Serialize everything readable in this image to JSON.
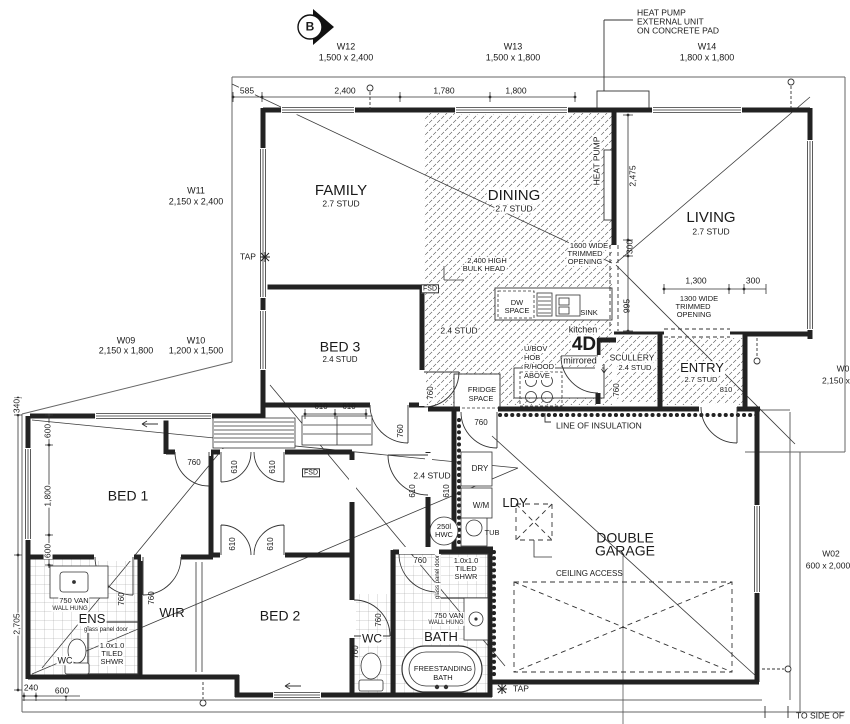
{
  "compass": {
    "label": "B"
  },
  "notes": {
    "heat_pump_unit": [
      "HEAT PUMP",
      "EXTERNAL UNIT",
      "ON CONCRETE PAD"
    ],
    "heat_pump_wall": "HEAT PUMP",
    "bulkhead": [
      "2,400 HIGH",
      "BULK HEAD"
    ],
    "trimmed_opening_1600": [
      "1600 WIDE",
      "TRIMMED",
      "OPENING"
    ],
    "trimmed_opening_1300": [
      "1300 WIDE",
      "TRIMMED",
      "OPENING"
    ],
    "line_of_insulation": "LINE OF INSULATION",
    "ceiling_access": "CEILING ACCESS",
    "to_side_of": "TO SIDE OF",
    "tap": "TAP",
    "fsd": "FSD",
    "glass_panel_door": "glass panel door",
    "kitchen": "kitchen",
    "kitchen_code": "4D",
    "mirrored": "mirrored"
  },
  "windows": {
    "w12": {
      "id": "W12",
      "size": "1,500 x 2,400"
    },
    "w13": {
      "id": "W13",
      "size": "1,500 x 1,800"
    },
    "w14": {
      "id": "W14",
      "size": "1,800 x 1,800"
    },
    "w11": {
      "id": "W11",
      "size": "2,150 x 2,400"
    },
    "w09": {
      "id": "W09",
      "size": "2,150 x 1,800"
    },
    "w10": {
      "id": "W10",
      "size": "1,200 x 1,500"
    },
    "w02": {
      "id": "W02",
      "size": "600 x 2,000"
    },
    "w01": {
      "id": "W0",
      "size": "2,150 x"
    }
  },
  "rooms": {
    "family": {
      "name": "FAMILY",
      "stud": "2.7 STUD"
    },
    "dining": {
      "name": "DINING",
      "stud": "2.7 STUD"
    },
    "living": {
      "name": "LIVING",
      "stud": "2.7 STUD"
    },
    "entry": {
      "name": "ENTRY",
      "stud": "2.7 STUD"
    },
    "scullery": {
      "name": "SCULLERY",
      "stud": "2.4 STUD"
    },
    "bed3": {
      "name": "BED 3",
      "stud": "2.4 STUD"
    },
    "bed1": {
      "name": "BED 1"
    },
    "bed2": {
      "name": "BED 2"
    },
    "wir": {
      "name": "WIR"
    },
    "ens": {
      "name": "ENS"
    },
    "wc": {
      "name": "WC"
    },
    "bath": {
      "name": "BATH"
    },
    "ldy": {
      "name": "LDY"
    },
    "garage": {
      "name1": "DOUBLE",
      "name2": "GARAGE"
    },
    "stud24": "2.4 STUD"
  },
  "fixtures": {
    "dw": [
      "DW",
      "SPACE"
    ],
    "sink": "SINK",
    "hob": [
      "U/BOV",
      "HOB",
      "R/HOOD",
      "ABOVE"
    ],
    "fridge": [
      "FRIDGE",
      "SPACE"
    ],
    "dry": "DRY",
    "wm": "W/M",
    "tub": "TUB",
    "hwc": [
      "250l",
      "HWC"
    ],
    "vanity": [
      "750 VAN",
      "WALL HUNG"
    ],
    "shower": [
      "1.0x1.0",
      "TILED",
      "SHWR"
    ],
    "bath_tub": [
      "FREESTANDING",
      "BATH"
    ]
  },
  "dims": {
    "d585": "585",
    "d2400": "2,400",
    "d1780": "1,780",
    "d1800": "1,800",
    "d2475": "2,475",
    "d300": "300",
    "d995": "995",
    "d1300": "1,300",
    "d610": "610",
    "d760": "760",
    "d810": "810",
    "d340": "340",
    "d600": "600",
    "d2705": "2,705",
    "d240": "240"
  }
}
